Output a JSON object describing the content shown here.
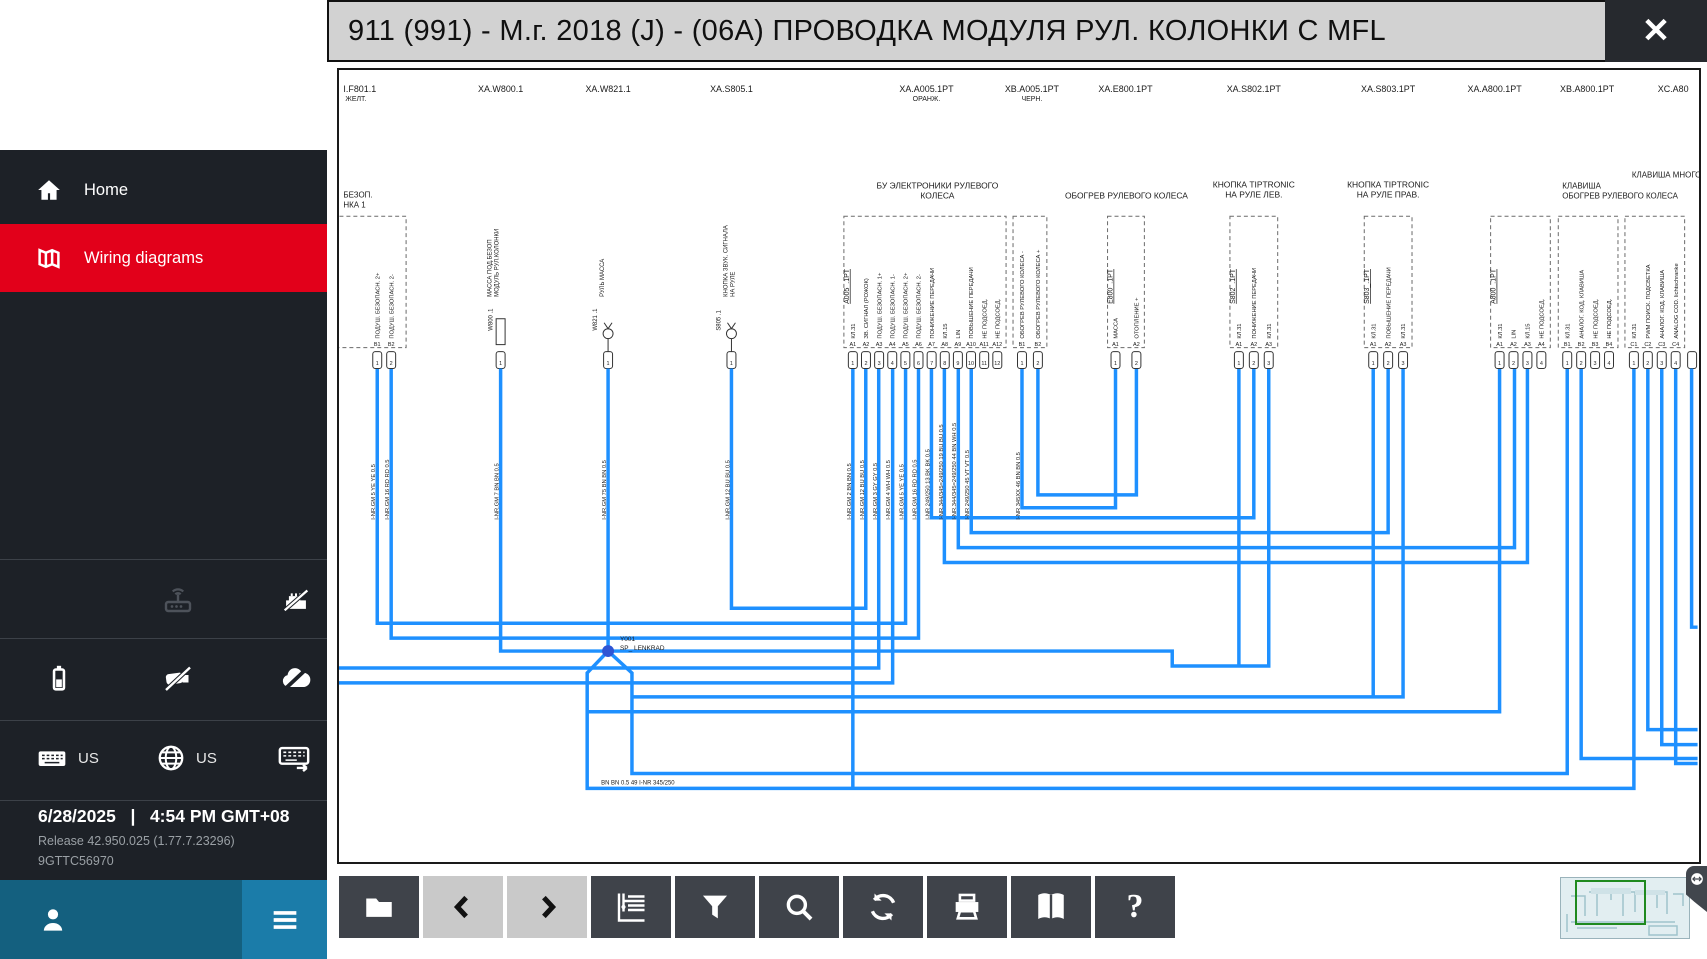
{
  "titlebar": {
    "title": "911 (991) - М.г. 2018 (J) - (06А) ПРОВОДКА МОДУЛЯ РУЛ. КОЛОНКИ С MFL",
    "close_icon": "✕"
  },
  "sidebar": {
    "nav": [
      {
        "label": "Home"
      },
      {
        "label": "Wiring diagrams"
      }
    ],
    "active_color": "#e2001a",
    "status_icons": {
      "row1": [
        "wifi-router",
        "ethernet-disconnected"
      ],
      "row2": [
        "battery",
        "vci-disconnected",
        "cloud-disconnected"
      ],
      "row3": [
        "keyboard-layout",
        "language-globe",
        "onscreen-keyboard"
      ]
    },
    "keyboard_layout": "US",
    "language": "US",
    "date": "6/28/2025",
    "separator": "|",
    "time": "4:54 PM GMT+08",
    "release": "Release 42.950.025 (1.77.7.23296)",
    "device_id": "9GTTC56970"
  },
  "toolbar": {
    "buttons": [
      {
        "name": "open-diagram",
        "enabled": true
      },
      {
        "name": "previous",
        "enabled": false
      },
      {
        "name": "next",
        "enabled": false
      },
      {
        "name": "diagram-tree",
        "enabled": true
      },
      {
        "name": "filter",
        "enabled": true
      },
      {
        "name": "search",
        "enabled": true
      },
      {
        "name": "refresh",
        "enabled": true
      },
      {
        "name": "print",
        "enabled": true
      },
      {
        "name": "manual",
        "enabled": true
      },
      {
        "name": "help",
        "enabled": true
      }
    ],
    "help_glyph": "?"
  },
  "diagram": {
    "wire_color": "#1e90ff",
    "top_labels": [
      {
        "id": "I.F801.1",
        "sub": "ЖЕЛТ."
      },
      {
        "id": "XA.W800.1"
      },
      {
        "id": "XA.W821.1"
      },
      {
        "id": "XA.S805.1"
      },
      {
        "id": "XA.A005.1PT",
        "sub": "ОРАНЖ."
      },
      {
        "id": "XB.A005.1PT",
        "sub": "ЧЕРН."
      },
      {
        "id": "XA.E800.1PT"
      },
      {
        "id": "XA.S802.1PT"
      },
      {
        "id": "XA.S803.1PT"
      },
      {
        "id": "XA.A800.1PT"
      },
      {
        "id": "XB.A800.1PT"
      },
      {
        "id": "XC.A80"
      }
    ],
    "f801": {
      "t1": "БЕЗОП.",
      "t2": "НКА 1",
      "pins": [
        {
          "n": "B1",
          "t": "1",
          "d": "ПОДУШ. БЕЗОПАСН. 2+",
          "w": "I-NR.GM  5  YE YE 0.5"
        },
        {
          "n": "B2",
          "t": "2",
          "d": "ПОДУШ. БЕЗОПАСН. 2-",
          "w": "I-NR.GM  16  RD RD 0.5"
        }
      ]
    },
    "w800": {
      "conn": "W800 .1",
      "d1": "МАССА ПОД.БЕЗОП",
      "d2": "МОДУЛЬ РУЛ.КОЛОНКИ",
      "t": "1",
      "w": "I-NR.GM  7  BN BN 0.5"
    },
    "w821": {
      "conn": "W821 .1",
      "d1": "РУЛЬ МАССА",
      "t": "1",
      "w": "I-NR.GM  75  BN BN 0.5"
    },
    "s805": {
      "conn": "S805 .1",
      "d1": "КНОПКА ЗВУК. СИГНАЛА",
      "d2": "НА РУЛЕ",
      "t": "1",
      "w": "I-NR.GM  12  BU BU 0.5"
    },
    "a005": {
      "t1": "БУ ЭЛЕКТРОНИКИ РУЛЕВОГО",
      "t2": "КОЛЕСА",
      "conn": "A005_.1PT",
      "pins": [
        {
          "n": "A1",
          "t": "1",
          "d": "КЛ.31",
          "w": "I-NR.GM  2  BN BN 0.5"
        },
        {
          "n": "A2",
          "t": "2",
          "d": "ЗВ. СИГНАЛ (РОЖОК)",
          "w": "I-NR.GM  12  BU BU 0.5"
        },
        {
          "n": "A3",
          "t": "3",
          "d": "ПОДУШ. БЕЗОПАСН. 1+",
          "w": "I-NR.GM  3  GY GY 0.5"
        },
        {
          "n": "A4",
          "t": "4",
          "d": "ПОДУШ. БЕЗОПАСН. 1-",
          "w": "I-NR.GM  4  WH WH 0.5"
        },
        {
          "n": "A5",
          "t": "5",
          "d": "ПОДУШ. БЕЗОПАСН. 2+",
          "w": "I-NR.GM  5  YE YE 0.5"
        },
        {
          "n": "A6",
          "t": "6",
          "d": "ПОДУШ. БЕЗОПАСН. 2-",
          "w": "I-NR.GM  16  RD RD 0.5"
        },
        {
          "n": "A7",
          "t": "7",
          "d": "ПОНИЖЕНИЕ ПЕРЕДАЧИ",
          "w": "I-NR 249/250  13  BK BK 0.5"
        },
        {
          "n": "A8",
          "t": "8",
          "d": "КЛ.15",
          "w": "I-NR.344/345=249/250  19  BU BU 0.5"
        },
        {
          "n": "A9",
          "t": "9",
          "d": "LIN",
          "w": "I-NR.344/345=249/250  44  BN WH 0.5"
        },
        {
          "n": "A10",
          "t": "10",
          "d": "ПОВЫШЕНИЕ ПЕРЕДАЧИ",
          "w": "I-NR 249/250  45  VT VT 0.5"
        },
        {
          "n": "A11",
          "t": "11",
          "d": "НЕ ПОДСОЕД."
        },
        {
          "n": "A12",
          "t": "12",
          "d": "НЕ ПОДСОЕД."
        }
      ],
      "bpins": [
        {
          "n": "B1",
          "t": "1",
          "d": "ОБОГРЕВ РУЛЕВОГО КОЛЕСА -",
          "w": "I-NR 345XX  46  BN BN 0.5"
        },
        {
          "n": "B2",
          "t": "2",
          "d": "ОБОГРЕВ РУЛЕВОГО КОЛЕСА +"
        }
      ]
    },
    "e800": {
      "title": "ОБОГРЕВ РУЛЕВОГО КОЛЕСА",
      "conn": "E800_.1PT",
      "pins": [
        {
          "n": "A1",
          "t": "1",
          "d": "МАССА"
        },
        {
          "n": "A2",
          "t": "2",
          "d": "ОТОПЛЕНИЕ +"
        }
      ]
    },
    "s802": {
      "t1": "КНОПКА TIPTRONIC",
      "t2": "НА РУЛЕ ЛЕВ.",
      "conn": "S802_.1PT",
      "pins": [
        {
          "n": "A1",
          "t": "1",
          "d": "КЛ.31"
        },
        {
          "n": "A2",
          "t": "2",
          "d": "ПОНИЖЕНИЕ ПЕРЕДАЧИ"
        },
        {
          "n": "A3",
          "t": "3",
          "d": "КЛ.31"
        }
      ]
    },
    "s803": {
      "t1": "КНОПКА TIPTRONIC",
      "t2": "НА РУЛЕ ПРАВ.",
      "conn": "S803_.1PT",
      "pins": [
        {
          "n": "A1",
          "t": "1",
          "d": "КЛ.31"
        },
        {
          "n": "A2",
          "t": "2",
          "d": "ПОВЫШЕНИЕ ПЕРЕДАЧИ"
        },
        {
          "n": "A3",
          "t": "3",
          "d": "КЛ.31"
        }
      ]
    },
    "a800": {
      "t1": "КЛАВИША",
      "t2": "ОБОГРЕВ РУЛЕВОГО КОЛЕСА",
      "conn": "A800_.1PT",
      "apins": [
        {
          "n": "A1",
          "t": "1",
          "d": "КЛ.31"
        },
        {
          "n": "A2",
          "t": "2",
          "d": "LIN"
        },
        {
          "n": "A3",
          "t": "3",
          "d": "КЛ.15"
        },
        {
          "n": "A4",
          "t": "4",
          "d": "НЕ ПОДСОЕД."
        }
      ],
      "bpins": [
        {
          "n": "B1",
          "t": "1",
          "d": "КЛ.31"
        },
        {
          "n": "B2",
          "t": "2",
          "d": "АНАЛОГ. КОД. КЛАВИША"
        },
        {
          "n": "B3",
          "t": "3",
          "d": "НЕ ПОДСОЕД."
        },
        {
          "n": "B4",
          "t": "4",
          "d": "НЕ ПОДСОЕД."
        }
      ],
      "cpins": [
        {
          "n": "C1",
          "t": "1",
          "d": "КЛ.31"
        },
        {
          "n": "C2",
          "t": "2",
          "d": "PWM ПОИСК. ПОДСВЕТКА"
        },
        {
          "n": "C3",
          "t": "3",
          "d": "АНАЛОГ. КОД. КЛАВИША"
        },
        {
          "n": "C4",
          "t": "4",
          "d": "ANALOG COD. lichtschranke"
        }
      ]
    },
    "multi_title": "КЛАВИША МНОГО",
    "splice": {
      "id": "Y001",
      "name": "SP_ LENKRAD"
    },
    "bottom_wire": "BN BN 0.5    49         I-NR 345/250"
  }
}
